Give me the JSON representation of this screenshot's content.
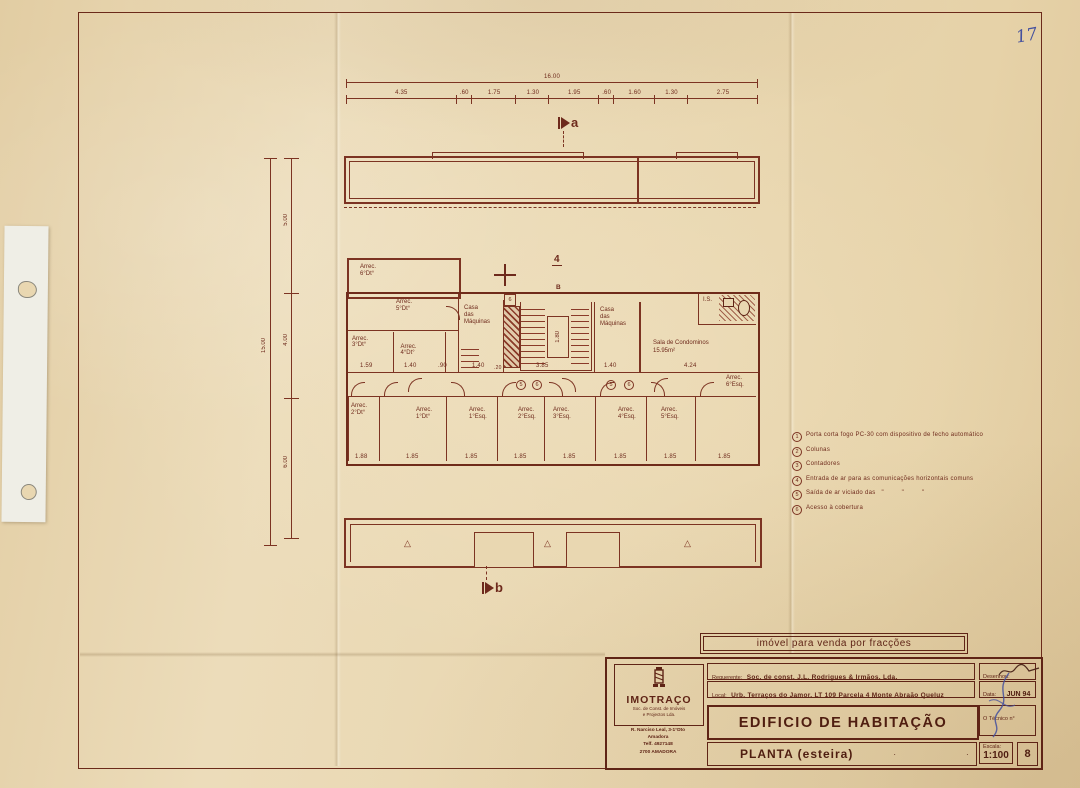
{
  "sheet": {
    "handwritten_page_number": "17"
  },
  "stamp": {
    "text": "imóvel para venda por fracções"
  },
  "legend": {
    "items": [
      {
        "num": "1",
        "text": "Porta corta fogo PC-30 com dispositivo de fecho automático"
      },
      {
        "num": "2",
        "text": "Colunas"
      },
      {
        "num": "3",
        "text": "Contadores"
      },
      {
        "num": "4",
        "text": "Entrada de ar para as comunicações horizontais comuns"
      },
      {
        "num": "5",
        "text": "Saída de ar viciado das   \"         \"         \""
      },
      {
        "num": "6",
        "text": "Acesso à cobertura"
      }
    ]
  },
  "plan": {
    "dims_top": {
      "total": "16.00",
      "segments": [
        "4.35",
        ".60",
        "1.75",
        "1.30",
        "1.95",
        ".60",
        "1.60",
        "1.30",
        "2.75"
      ]
    },
    "dims_left": {
      "total": "15.00",
      "segments": [
        "5.00",
        "4.00",
        "6.00"
      ]
    },
    "section_a": "a",
    "section_b": "b",
    "marker_B": "B",
    "marker_4": "4",
    "marker_5": "5",
    "marker_6": "6",
    "triangle": "△",
    "stair_dim": "1.80",
    "rooms": {
      "arrec6dt": "Arrec.\n6°Dt°",
      "arrec5dt": "Arrec.\n5°Dt°",
      "arrec3dt": "Arrec.\n3°Dt°",
      "arrec4dt": "Arrec.\n4°Dt°",
      "casa_maq": "Casa\ndas\nMáquinas",
      "sala": "Sala de Condominos",
      "sala_area": "15.95m²",
      "is": "I.S.",
      "arrec2dt": "Arrec.\n2°Dt°",
      "arrec1dt": "Arrec.\n1°Dt°",
      "arrec1esq": "Arrec.\n1°Esq.",
      "arrec2esq": "Arrec.\n2°Esq.",
      "arrec3esq": "Arrec.\n3°Esq.",
      "arrec4esq": "Arrec.\n4°Esq.",
      "arrec5esq": "Arrec.\n5°Esq.",
      "arrec6esq": "Arrec.\n6°Esq."
    },
    "mid_dims": [
      "1.59",
      "1.40",
      ".90",
      "1.40",
      ".20",
      "3.85",
      "1.40",
      "4.24"
    ],
    "bottom_dims": [
      "1.88",
      "1.85",
      "1.85",
      "1.85",
      "1.85",
      "1.85",
      "1.85",
      "1.85"
    ]
  },
  "title_block": {
    "company": {
      "name": "IMOTRAÇO",
      "subtitle": "Soc. de Const. de Imóveis\ne Projectos Lda.",
      "address": "R. Narciso Leal, 3-1°Dto\nAmadora\nTelf. 4927148\n2700 AMADORA"
    },
    "requerente_label": "Requerente:",
    "requerente_value": "Soc. de const. J.L. Rodrigues & Irmãos, Lda.",
    "local_label": "Local:",
    "local_value": "Urb. Terraços do Jamor, LT 109 Parcela 4 Monte Abraão Queluz",
    "project_title": "EDIFICIO  DE  HABITAÇÃO",
    "drawing_title": "PLANTA  (esteira)",
    "desenhou_label": "Desenhou:",
    "data_label": "Data:",
    "data_value": "JUN 94",
    "tecnico_label": "O Técnico n°",
    "escala_label": "Escala:",
    "escala_value": "1:100",
    "sheet_number": "8"
  }
}
